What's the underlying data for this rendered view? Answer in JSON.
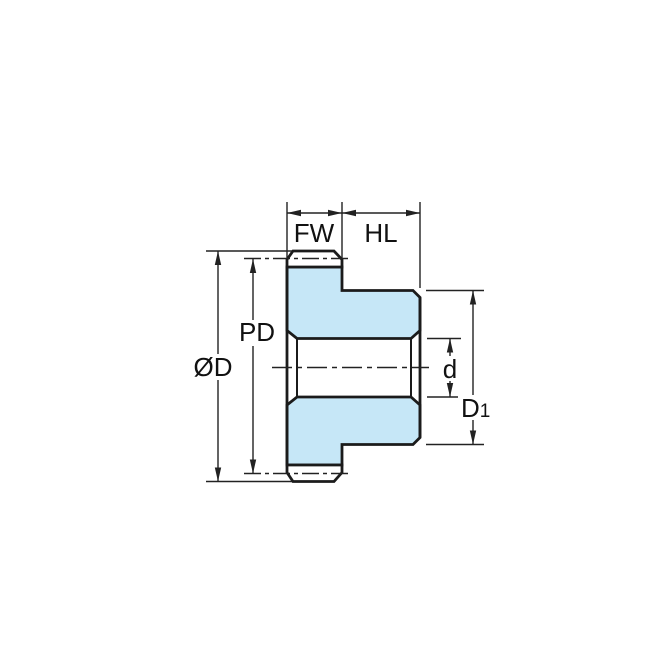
{
  "drawing": {
    "type": "gear-cross-section-dimension-diagram",
    "labels": {
      "face_width": "FW",
      "hub_length": "HL",
      "pitch_diameter": "PD",
      "outer_diameter": "ØD",
      "bore_diameter": "d",
      "hub_diameter_base": "D",
      "hub_diameter_sub": "1"
    },
    "colors": {
      "section_fill": "#c6e7f7",
      "outline": "#1b1b1b",
      "dimension_lines": "#222222",
      "background": "#ffffff"
    }
  }
}
